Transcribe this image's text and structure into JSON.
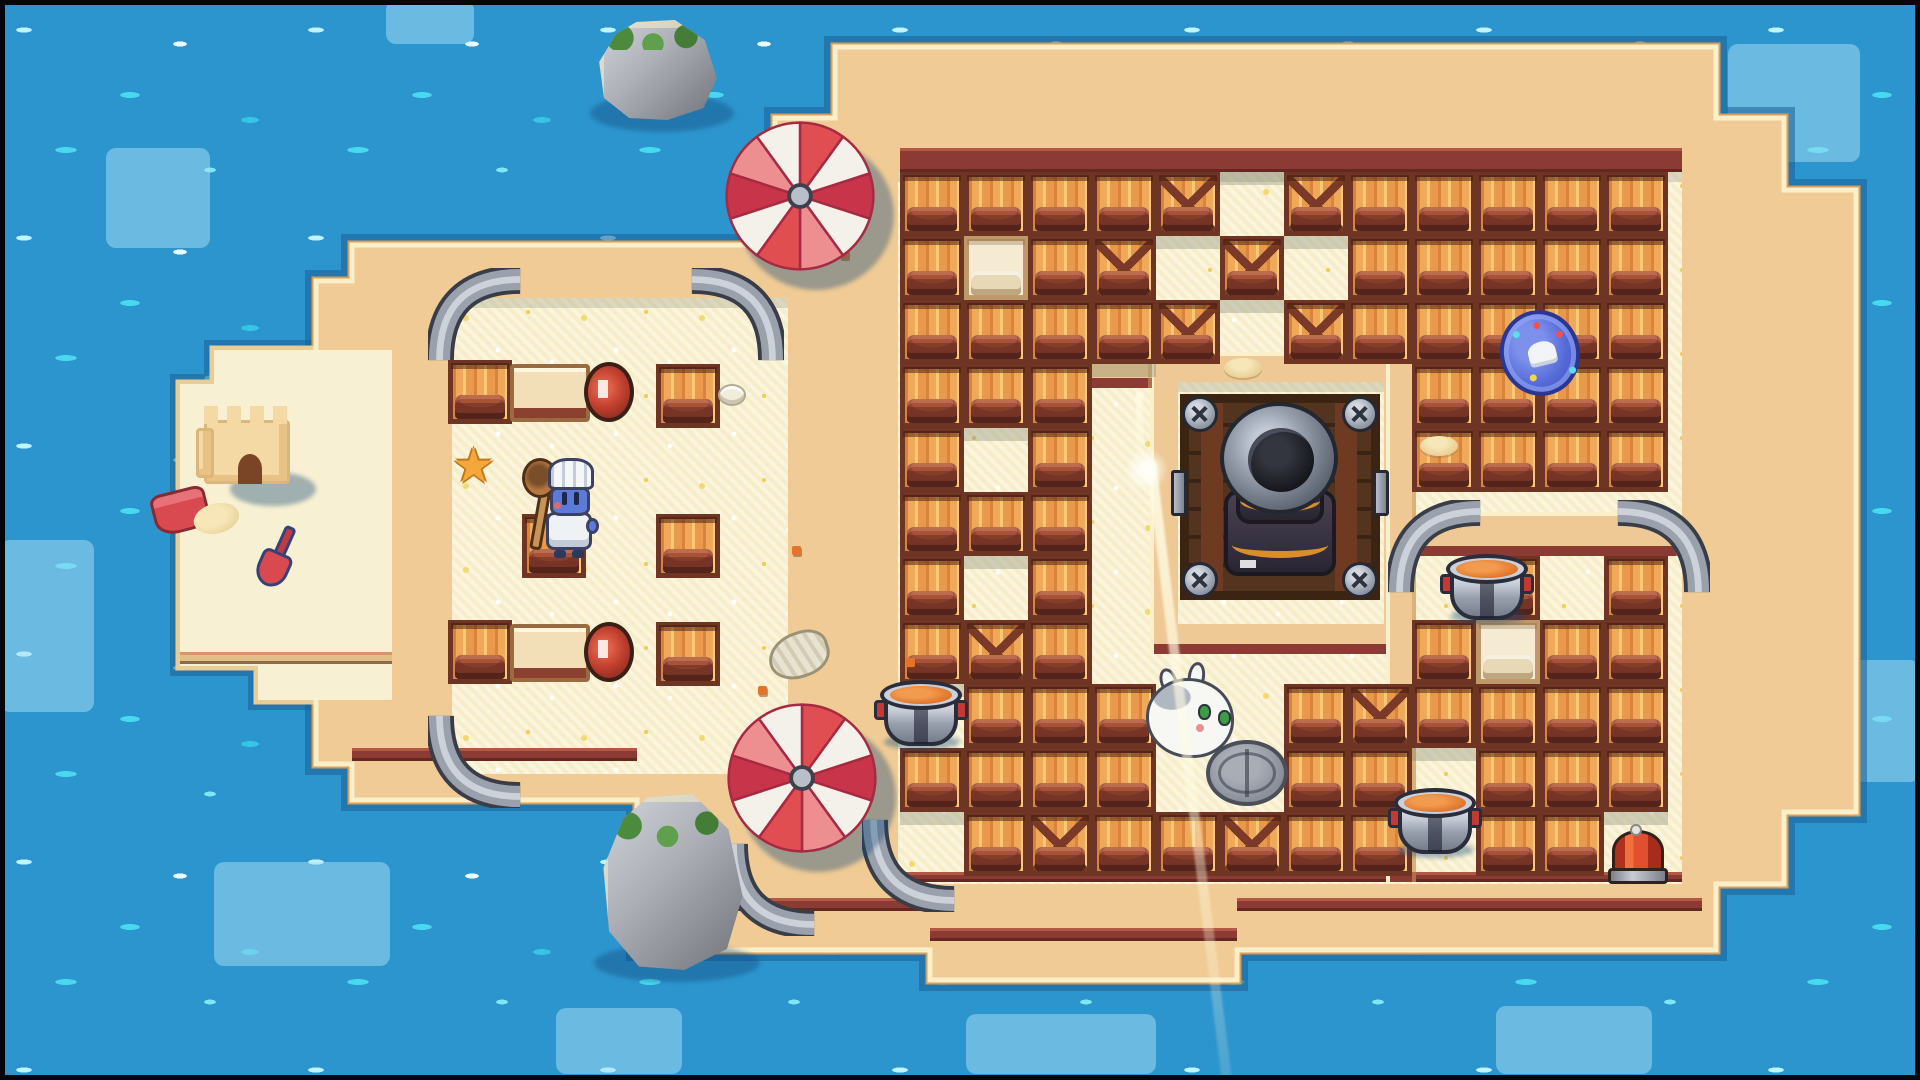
{
  "meta": {
    "title": "beach-arena-game-scene",
    "width": 1920,
    "height": 1080
  },
  "palette": {
    "water": "#2D95CE",
    "water_sparkle": "#46D9EF",
    "water_patch": "#A8DFF6",
    "sand_tan": "#F0CB96",
    "sand_pale": "#FBF5DE",
    "edge_cream": "#FAEFCB",
    "edge_orange": "#DF9C53",
    "shore_shadow": "#2273AC",
    "trim_maroon": "#8C3B34",
    "beach_trim": "#E0BE85",
    "crate_orange": "#F0A85A",
    "crate_frame": "#6E3424",
    "metal_gray": "#9AA1AD",
    "soup_orange": "#E0762A",
    "umbrella_red": "#E04E52",
    "umbrella_deep": "#C8354A",
    "umbrella_pink": "#ED8E90",
    "umbrella_white": "#F4F0EA",
    "badge_blue": "#5468D6",
    "chef_blue": "#5C7AD8"
  },
  "island": {
    "main_path": "M352,245 L775,245 L775,118 L835,118 L835,47 L1716,47 L1716,118 L1784,118 L1784,190 L1856,190 L1856,812 L1784,812 L1784,884 L1716,884 L1716,950 L1237,950 L1237,980 L930,980 L930,950 L637,950 L637,800 L352,800 L352,764 L316,764 L316,281 L352,281 Z",
    "beach_path": "M214,350 L392,350 L392,700 L258,700 L258,666 L180,666 L180,384 L214,384 Z"
  },
  "water": {
    "patches": [
      [
        106,
        148,
        104,
        100
      ],
      [
        0,
        540,
        94,
        172
      ],
      [
        214,
        862,
        176,
        104
      ],
      [
        386,
        0,
        88,
        44
      ],
      [
        1728,
        44,
        132,
        118
      ],
      [
        1698,
        214,
        64,
        122
      ],
      [
        1764,
        660,
        156,
        122
      ],
      [
        1496,
        1006,
        156,
        68
      ],
      [
        966,
        1014,
        190,
        60
      ],
      [
        556,
        1008,
        126,
        66
      ]
    ],
    "small_rocks": [
      [
        84,
        236
      ],
      [
        62,
        514
      ],
      [
        18,
        744
      ],
      [
        244,
        978
      ],
      [
        1836,
        20
      ],
      [
        1878,
        130
      ],
      [
        1858,
        346
      ],
      [
        1550,
        1026
      ],
      [
        1318,
        1044
      ],
      [
        420,
        1034
      ],
      [
        1896,
        756
      ]
    ]
  },
  "floors": {
    "arena": [
      898,
      172,
      784,
      712
    ],
    "left_room": [
      452,
      298,
      336,
      476
    ],
    "enclosure_inner": [
      1178,
      382,
      206,
      242
    ]
  },
  "walls": [
    [
      1150,
      352,
      262,
      302
    ],
    [
      1386,
      352,
      30,
      530
    ],
    [
      1416,
      512,
      264,
      44
    ],
    [
      1088,
      360,
      64,
      28
    ]
  ],
  "trims": [
    {
      "r": [
        900,
        148,
        782,
        24
      ],
      "c": "#8C3B34"
    },
    {
      "r": [
        900,
        872,
        782,
        10
      ],
      "c": "#8C3B34"
    },
    {
      "r": [
        352,
        748,
        285,
        13
      ],
      "c": "#8C3B34"
    },
    {
      "r": [
        637,
        898,
        293,
        13
      ],
      "c": "#8C3B34"
    },
    {
      "r": [
        930,
        928,
        307,
        13
      ],
      "c": "#8C3B34"
    },
    {
      "r": [
        1237,
        898,
        465,
        13
      ],
      "c": "#8C3B34"
    },
    {
      "r": [
        180,
        652,
        212,
        12
      ],
      "c": "#E0BE85"
    }
  ],
  "rails": [
    [
      428,
      268,
      0
    ],
    [
      688,
      268,
      90
    ],
    [
      428,
      712,
      270
    ],
    [
      1388,
      500,
      0
    ],
    [
      1614,
      500,
      90
    ],
    [
      862,
      816,
      270
    ],
    [
      722,
      840,
      270
    ]
  ],
  "grid": {
    "x0": 900,
    "y0": 172,
    "tile": 64,
    "legend": {
      "#": "crate",
      "X": "crate-x-braced",
      "P": "crate-pale",
      ".": "floor",
      "_": "covered-by-wall"
    },
    "rows": [
      "####X.X#####",
      "#P#X.X.#####",
      "####X.X#####",
      "###.____####",
      "#.#.____####",
      "###.________",
      "#.#.____.#.#",
      "#X#.____#P##",
      ".###..#X####",
      "####..##.###",
      ".#X##X##.##."
    ]
  },
  "entities": [
    {
      "t": "rock",
      "x": 598,
      "y": 20,
      "w": 120,
      "h": 100
    },
    {
      "t": "rock",
      "x": 602,
      "y": 794,
      "w": 142,
      "h": 176
    },
    {
      "t": "castle",
      "x": 196,
      "y": 398
    },
    {
      "t": "bucket",
      "x": 154,
      "y": 482
    },
    {
      "t": "shovel",
      "x": 248,
      "y": 524
    },
    {
      "t": "crate1",
      "x": 448,
      "y": 360
    },
    {
      "t": "launcher",
      "x": 510,
      "y": 360
    },
    {
      "t": "crate1",
      "x": 656,
      "y": 364
    },
    {
      "t": "shell",
      "x": 718,
      "y": 384
    },
    {
      "t": "star",
      "x": 452,
      "y": 442
    },
    {
      "t": "crate1",
      "x": 522,
      "y": 514
    },
    {
      "t": "crate1",
      "x": 656,
      "y": 514
    },
    {
      "t": "crate1",
      "x": 448,
      "y": 620
    },
    {
      "t": "launcher",
      "x": 510,
      "y": 620
    },
    {
      "t": "crate1",
      "x": 656,
      "y": 622
    },
    {
      "t": "shellBig",
      "x": 768,
      "y": 632
    },
    {
      "t": "crumb",
      "x": 792,
      "y": 546
    },
    {
      "t": "crumb",
      "x": 758,
      "y": 686
    },
    {
      "t": "crumb",
      "x": 906,
      "y": 658
    },
    {
      "t": "crumb",
      "x": 840,
      "y": 250
    },
    {
      "t": "pile",
      "x": 1224,
      "y": 358
    },
    {
      "t": "pile",
      "x": 1420,
      "y": 436
    },
    {
      "t": "pile",
      "x": 1236,
      "y": 444
    },
    {
      "t": "pot",
      "x": 878,
      "y": 676
    },
    {
      "t": "pot",
      "x": 1444,
      "y": 550
    },
    {
      "t": "pot",
      "x": 1392,
      "y": 784
    },
    {
      "t": "bumper",
      "x": 1608,
      "y": 830
    },
    {
      "t": "badge",
      "x": 1500,
      "y": 310
    },
    {
      "t": "manhole",
      "x": 1206,
      "y": 740
    },
    {
      "t": "cannon",
      "x": 1180,
      "y": 394
    },
    {
      "t": "chef",
      "x": 528,
      "y": 458
    },
    {
      "t": "bunny",
      "x": 1144,
      "y": 674
    },
    {
      "t": "umbrella",
      "x": 722,
      "y": 118
    },
    {
      "t": "umbrella",
      "x": 724,
      "y": 700
    },
    {
      "t": "beam",
      "x": 1146,
      "y": 462
    }
  ]
}
